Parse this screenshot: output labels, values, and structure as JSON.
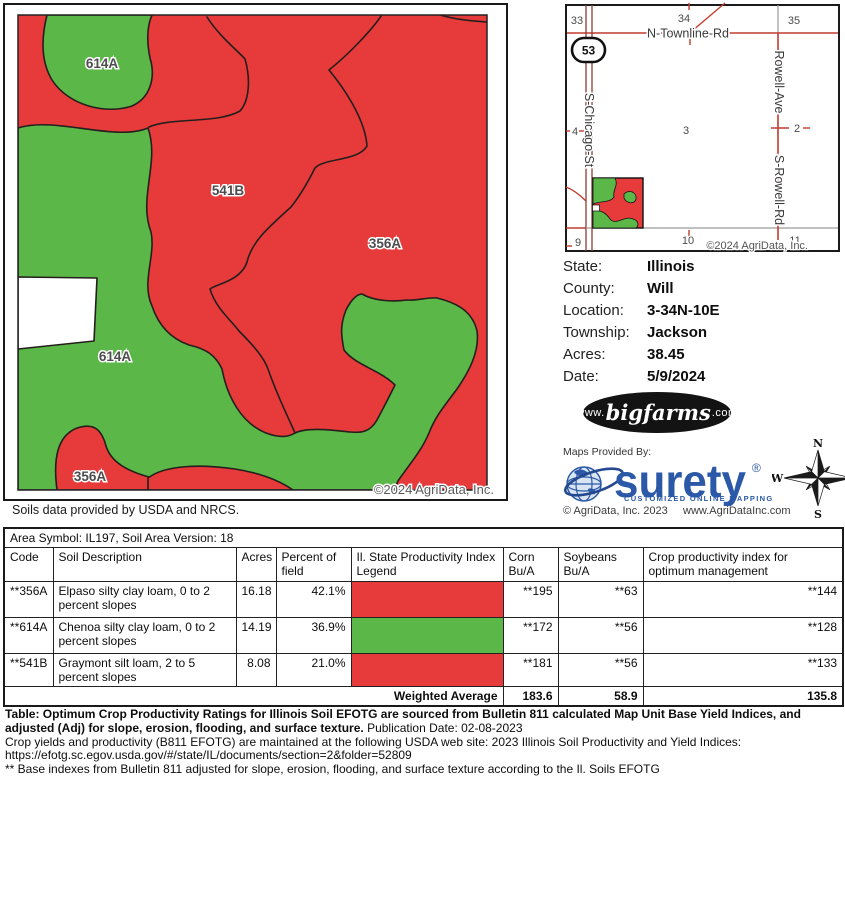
{
  "colors": {
    "soil_red": "#e63a3b",
    "soil_green": "#5ab748",
    "boundary": "#241f1c",
    "road_red": "#c23b2e",
    "road_brown": "#8e3d31",
    "road_gray": "#9a9a9a",
    "surety_blue": "#2b59a8"
  },
  "main_map": {
    "labels": [
      "614A",
      "541B",
      "356A",
      "614A",
      "356A"
    ],
    "copyright": "©2024 AgriData, Inc.",
    "caption": "Soils data provided by USDA and NRCS."
  },
  "inset_map": {
    "sections": [
      "33",
      "34",
      "35",
      "4",
      "3",
      "2",
      "9",
      "10",
      "11"
    ],
    "roads": {
      "n_townline": "N-Townline-Rd",
      "s_chicago": "S-Chicago-St",
      "rowell_ave": "Rowell-Ave",
      "s_rowell": "S-Rowell-Rd"
    },
    "shield": "53",
    "copyright": "©2024 AgriData, Inc."
  },
  "info": {
    "rows": [
      {
        "label": "State:",
        "value": "Illinois"
      },
      {
        "label": "County:",
        "value": "Will"
      },
      {
        "label": "Location:",
        "value": "3-34N-10E"
      },
      {
        "label": "Township:",
        "value": "Jackson"
      },
      {
        "label": "Acres:",
        "value": "38.45"
      },
      {
        "label": "Date:",
        "value": "5/9/2024"
      }
    ]
  },
  "logos": {
    "bigfarms_www": "www.",
    "bigfarms_name": "bigfarms",
    "bigfarms_com": ".com",
    "maps_provided_by": "Maps Provided By:",
    "surety_name": "surety",
    "surety_reg": "®",
    "surety_tagline": "CUSTOMIZED ONLINE MAPPING",
    "agridata_copyright": "© AgriData, Inc. 2023",
    "agridata_url": "www.AgriDataInc.com"
  },
  "compass": {
    "n": "N",
    "e": "E",
    "s": "S",
    "w": "W"
  },
  "soil_table": {
    "area_line": "Area Symbol: IL197, Soil Area Version: 18",
    "headers": [
      "Code",
      "Soil Description",
      "Acres",
      "Percent of field",
      "Il. State Productivity Index Legend",
      "Corn Bu/A",
      "Soybeans Bu/A",
      "Crop productivity index for optimum management"
    ],
    "rows": [
      {
        "code": "**356A",
        "description": "Elpaso silty clay loam, 0 to 2 percent slopes",
        "acres": "16.18",
        "percent": "42.1%",
        "legend_color": "#e63a3b",
        "corn": "**195",
        "soybeans": "**63",
        "crop_index": "**144"
      },
      {
        "code": "**614A",
        "description": "Chenoa silty clay loam, 0 to 2 percent slopes",
        "acres": "14.19",
        "percent": "36.9%",
        "legend_color": "#5ab748",
        "corn": "**172",
        "soybeans": "**56",
        "crop_index": "**128"
      },
      {
        "code": "**541B",
        "description": "Graymont silt loam, 2 to 5 percent slopes",
        "acres": "8.08",
        "percent": "21.0%",
        "legend_color": "#e63a3b",
        "corn": "**181",
        "soybeans": "**56",
        "crop_index": "**133"
      }
    ],
    "weighted": {
      "label": "Weighted Average",
      "corn": "183.6",
      "soybeans": "58.9",
      "crop_index": "135.8"
    }
  },
  "footnotes": {
    "table_bold": "Table: Optimum Crop Productivity Ratings for Illinois Soil EFOTG are sourced from Bulletin 811 calculated Map Unit Base Yield Indices, and adjusted (Adj) for slope, erosion, flooding, and surface texture.",
    "publication": "Publication Date: 02-08-2023",
    "crop_yields": "Crop yields and productivity (B811 EFOTG) are maintained at the following USDA web site: 2023 Illinois Soil Productivity and Yield Indices:",
    "url": "https://efotg.sc.egov.usda.gov/#/state/IL/documents/section=2&folder=52809",
    "base_indexes": "** Base indexes from Bulletin 811 adjusted for slope, erosion, flooding, and surface texture according to the Il. Soils EFOTG"
  }
}
